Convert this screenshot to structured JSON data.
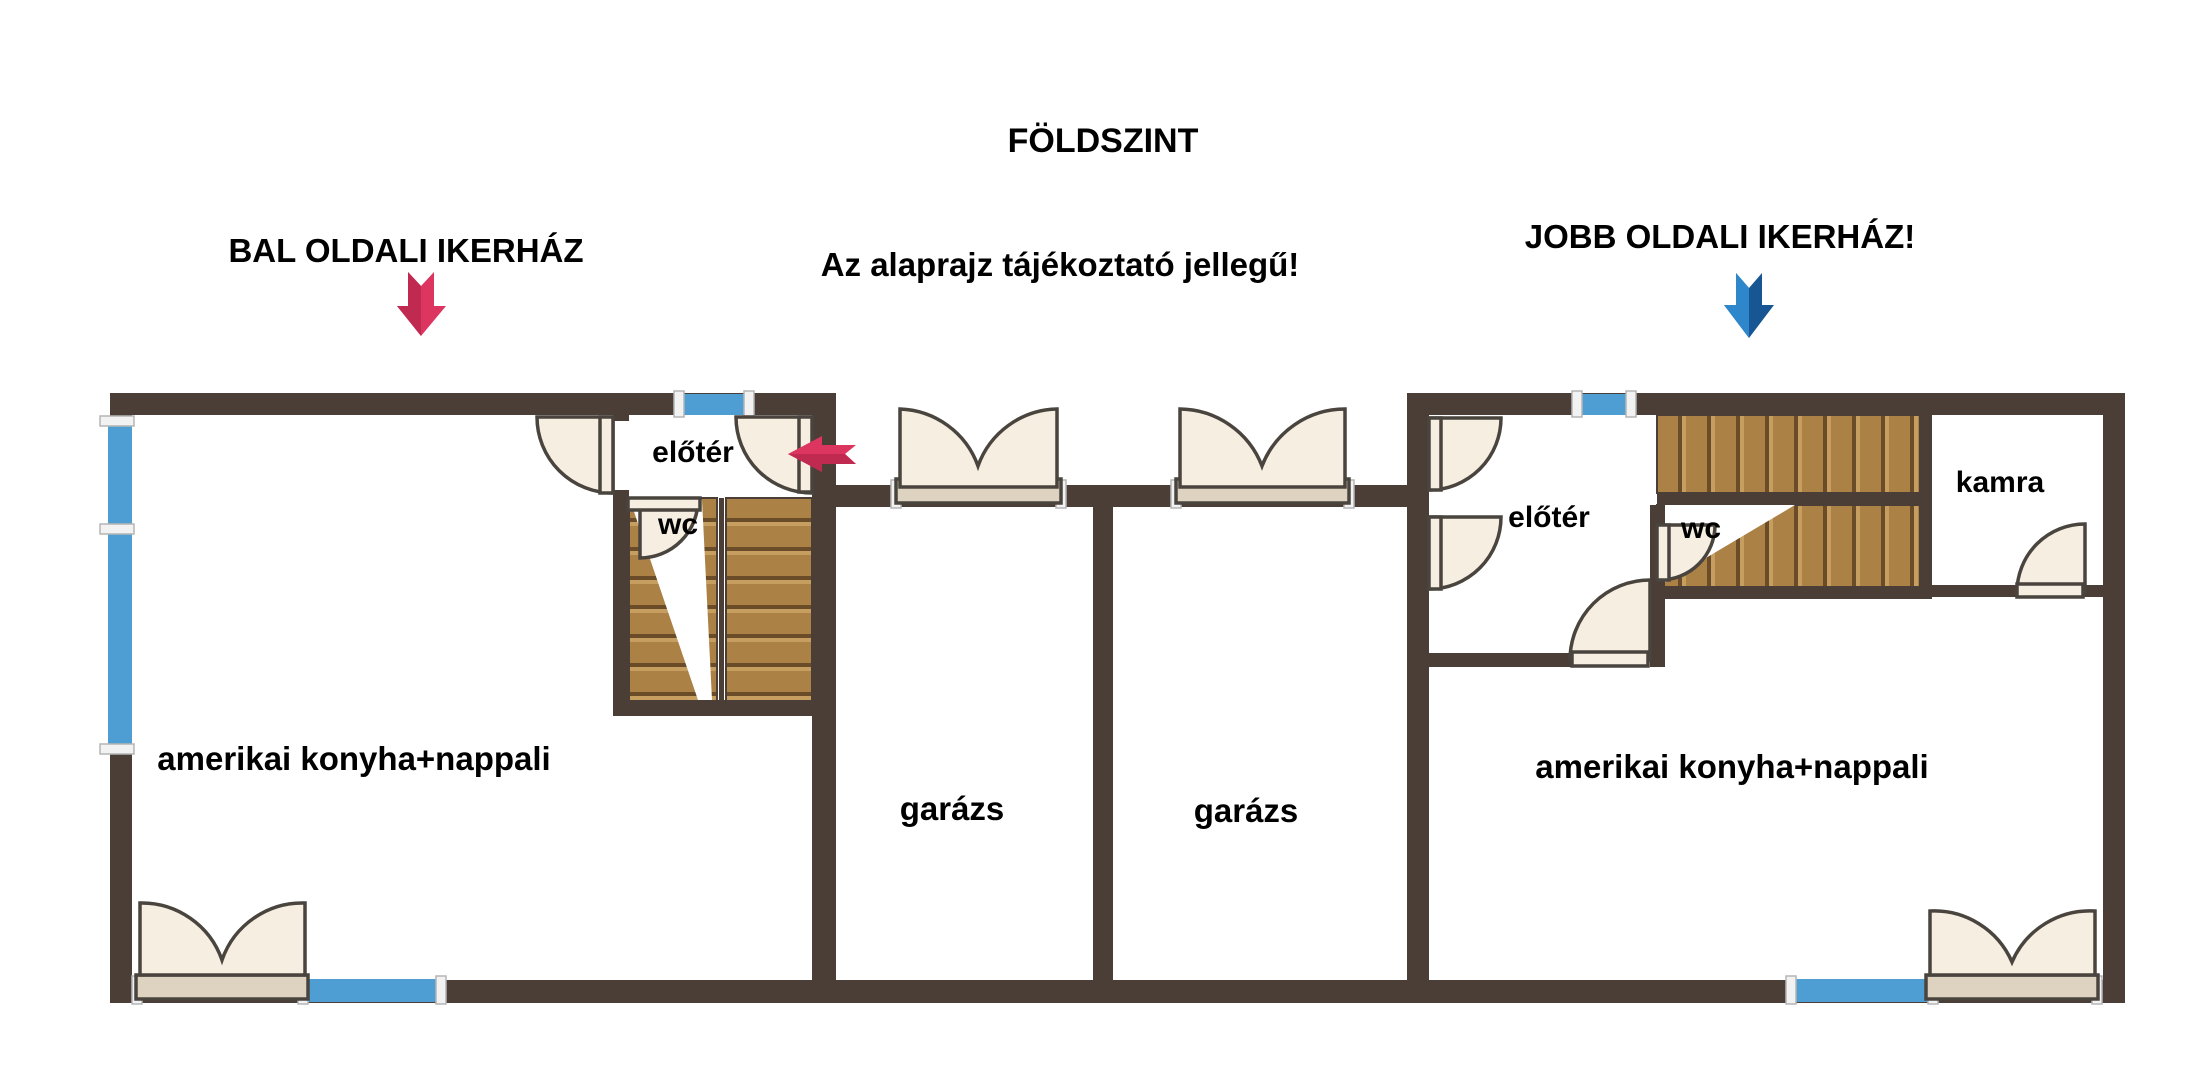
{
  "title": "FÖLDSZINT",
  "headings": {
    "left": "BAL OLDALI IKERHÁZ",
    "note": "Az alaprajz tájékoztató jellegű!",
    "right": "JOBB OLDALI IKERHÁZ!"
  },
  "rooms": {
    "left_hall": "előtér",
    "left_wc": "wc",
    "left_living": "amerikai konyha+nappali",
    "garage_left": "garázs",
    "garage_right": "garázs",
    "right_hall": "előtér",
    "right_wc": "wc",
    "right_pantry": "kamra",
    "right_living": "amerikai konyha+nappali"
  },
  "colors": {
    "wall": "#4a3e36",
    "window_blue": "#4f9ed3",
    "door_cream": "#f6eee1",
    "sill": "#ddd3c0",
    "wood": "#ab8146",
    "red_arrow": "#dc3560",
    "red_arrow_dark": "#c02950",
    "blue_arrow": "#2e87cb",
    "blue_arrow_dark": "#185593"
  }
}
